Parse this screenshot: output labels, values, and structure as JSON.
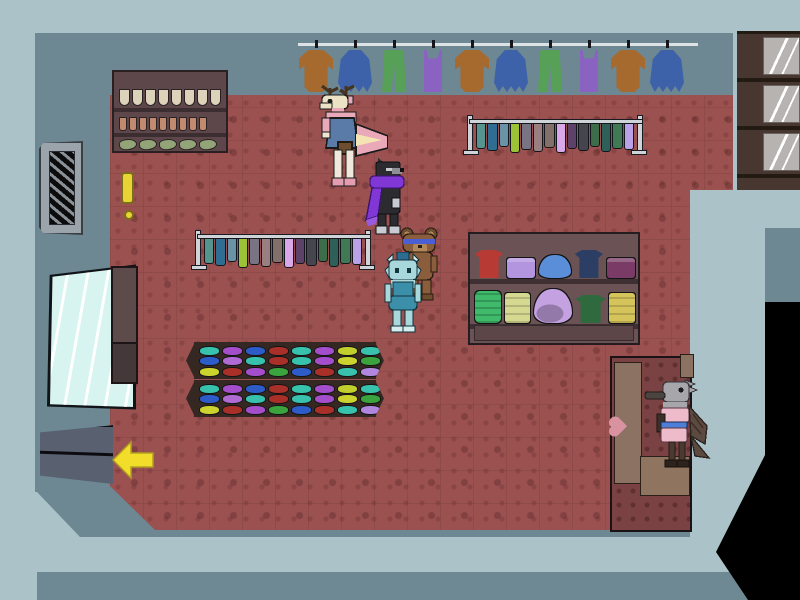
{
  "scene": {
    "title": "clothing-shop-interior",
    "view": "top-down pixel-art shop with five animal NPCs"
  },
  "palette": {
    "outer": "#abc2c8",
    "wall": "#6d8893",
    "band": "#6e8894",
    "floor": "#9b5150",
    "floor_pattern": "#7e4141",
    "black": "#000000",
    "changing_wall": "#7a4242",
    "changing_door": "#8b7263",
    "marker_yellow": "#e8d434",
    "arrow_yellow": "#f2de2a"
  },
  "rail": {
    "items": [
      {
        "type": "sweater",
        "color": "#a66a2e"
      },
      {
        "type": "skirt",
        "color": "#3e62aa"
      },
      {
        "type": "pants",
        "color": "#57a057"
      },
      {
        "type": "tank",
        "color": "#8a63c2"
      },
      {
        "type": "sweater",
        "color": "#a66a2e"
      },
      {
        "type": "skirt",
        "color": "#3e62aa"
      },
      {
        "type": "pants",
        "color": "#57a057"
      },
      {
        "type": "tank",
        "color": "#8a63c2"
      },
      {
        "type": "sweater",
        "color": "#a66a2e"
      },
      {
        "type": "skirt",
        "color": "#3e62aa"
      }
    ]
  },
  "racks": {
    "colors": [
      "#56948e",
      "#2f6e92",
      "#6a93a8",
      "#9cc236",
      "#787484",
      "#9a7e80",
      "#83706a",
      "#d8a8ea",
      "#5e4168",
      "#45454e",
      "#3c6c48",
      "#2e5f58",
      "#3f7a54",
      "#baa2e8"
    ],
    "heights": [
      24,
      26,
      22,
      28,
      25,
      27,
      23,
      28,
      24,
      26,
      22,
      27,
      24,
      25
    ]
  },
  "hat_tables": {
    "rows": [
      [
        "#38c2ae",
        "#a44ecb",
        "#2d5cc8",
        "#a93028",
        "#38c2ae",
        "#a44ecb",
        "#c2cd2e",
        "#38c2ae"
      ],
      [
        "#2d5cc8",
        "#b06ad4",
        "#38c2ae",
        "#a93028",
        "#38c2ae",
        "#a44ecb",
        "#ccd32f",
        "#3aa33e"
      ],
      [
        "#ccd32f",
        "#a93028",
        "#a44ecb",
        "#3aa33e",
        "#2d5cc8",
        "#a93028",
        "#38c2ae",
        "#b086de"
      ]
    ]
  },
  "display_shelf": {
    "top": [
      {
        "kind": "shirt",
        "color": "#b83a34"
      },
      {
        "kind": "folded",
        "color": "#b394de"
      },
      {
        "kind": "hat",
        "color": "#5b8ed8"
      },
      {
        "kind": "shirt",
        "color": "#2c3e64"
      },
      {
        "kind": "folded",
        "color": "#7a3c66"
      }
    ],
    "bottom": [
      {
        "kind": "roll",
        "color": "#3eba6a"
      },
      {
        "kind": "stack",
        "color": "#d4d890"
      },
      {
        "kind": "hatstack",
        "color": "#c4a2e2"
      },
      {
        "kind": "shirt",
        "color": "#2e6a3e"
      },
      {
        "kind": "stack",
        "color": "#d4c45a"
      }
    ]
  },
  "wall_shelf": {
    "rows": [
      {
        "class": "drop",
        "count": 8,
        "color": "#ddd2ba"
      },
      {
        "class": "glove",
        "count": 9,
        "color": "#c28a6e"
      },
      {
        "class": "shoe",
        "count": 5,
        "color": "#93a478"
      }
    ]
  },
  "cabinet": {
    "sections": 3
  },
  "npcs": [
    {
      "id": "deer",
      "label": "pink-deer-shopper",
      "colors": {
        "body": "#eaa9b8",
        "head": "#ece3c4",
        "dress": "#5a7ba8",
        "antler": "#463420",
        "tailstripe": "#f4e4b4",
        "bag": "#6e4e30"
      }
    },
    {
      "id": "wolf",
      "label": "black-wolf-with-purple-scarf",
      "colors": {
        "body": "#2b2b30",
        "scarf": "#8136d6",
        "paw": "#c9cbd3",
        "muzzle": "#8e8e96"
      }
    },
    {
      "id": "bear",
      "label": "small-brown-bear-kid",
      "colors": {
        "body": "#8a5d3c",
        "muzzle": "#b28759",
        "glasses": "#4a5fd4",
        "ear": "#6e4c30"
      }
    },
    {
      "id": "teal",
      "label": "teal-goat-shopper",
      "colors": {
        "body": "#a9d8dc",
        "fin": "#2c6c90",
        "suit": "#3b8fa8",
        "horn": "#d6ecec"
      }
    },
    {
      "id": "bird",
      "label": "gray-bird-at-changing-room",
      "colors": {
        "body": "#a7a7ab",
        "beak": "#4a4540",
        "top": "#eebbcb",
        "belt": "#4d7fd9",
        "wing": "#5c4a40",
        "glove": "#3a3028"
      }
    }
  ],
  "markers": {
    "exclamation_color": "#e8d434",
    "exit_arrow_color": "#f2de2a",
    "exit_arrow_direction": "left"
  }
}
